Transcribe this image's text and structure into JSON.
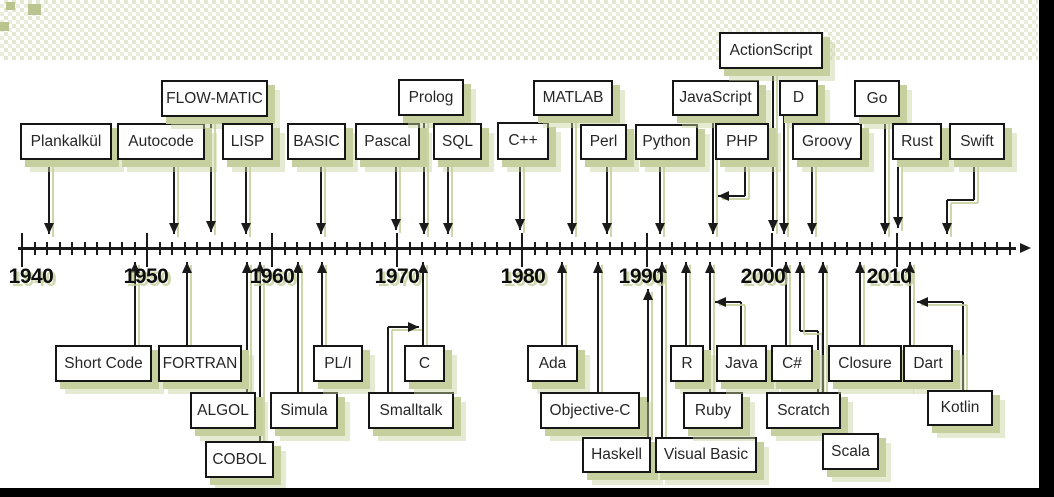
{
  "colors": {
    "shadow_green": "#c6d09f",
    "shadow_green_light": "#dde3c6",
    "line_black": "#1a1a1a",
    "box_border": "#161616",
    "box_bg": "#ffffff",
    "text": "#262626",
    "year_text": "#0d0d0d",
    "frame_black": "#000000"
  },
  "axis": {
    "y": 248,
    "x_start": 18,
    "x_end": 1016,
    "arrow_tip_x": 1031,
    "tick_start_x": 22,
    "tick_spacing": 12.5,
    "tick_count": 80,
    "decade_every": 10,
    "years": [
      {
        "label": "1940",
        "x": 31
      },
      {
        "label": "1950",
        "x": 146
      },
      {
        "label": "1960",
        "x": 272
      },
      {
        "label": "1970",
        "x": 397
      },
      {
        "label": "1980",
        "x": 523
      },
      {
        "label": "1990",
        "x": 641
      },
      {
        "label": "2000",
        "x": 763
      },
      {
        "label": "2010",
        "x": 889
      }
    ]
  },
  "languages": {
    "above": [
      {
        "label": "Plankalkül",
        "box": [
          20,
          123,
          92,
          37
        ],
        "line": [
          [
            49,
            160
          ],
          [
            49,
            234
          ]
        ],
        "arrow": "down"
      },
      {
        "label": "Autocode",
        "box": [
          117,
          123,
          88,
          37
        ],
        "line": [
          [
            174,
            160
          ],
          [
            174,
            234
          ]
        ],
        "arrow": "down"
      },
      {
        "label": "FLOW-MATIC",
        "box": [
          161,
          80,
          107,
          37
        ],
        "line": [
          [
            211,
            117
          ],
          [
            211,
            232
          ]
        ],
        "arrow": "down"
      },
      {
        "label": "LISP",
        "box": [
          222,
          123,
          51,
          37
        ],
        "line": [
          [
            246,
            160
          ],
          [
            246,
            234
          ]
        ],
        "arrow": "down"
      },
      {
        "label": "BASIC",
        "box": [
          287,
          123,
          59,
          37
        ],
        "line": [
          [
            321,
            160
          ],
          [
            321,
            234
          ]
        ],
        "arrow": "down"
      },
      {
        "label": "Pascal",
        "box": [
          355,
          123,
          65,
          37
        ],
        "line": [
          [
            396,
            160
          ],
          [
            396,
            230
          ]
        ],
        "arrow": "down"
      },
      {
        "label": "Prolog",
        "box": [
          398,
          79,
          66,
          37
        ],
        "line": [
          [
            424,
            116
          ],
          [
            424,
            234
          ]
        ],
        "arrow": "down"
      },
      {
        "label": "SQL",
        "box": [
          433,
          123,
          49,
          37
        ],
        "line": [
          [
            448,
            160
          ],
          [
            448,
            234
          ]
        ],
        "arrow": "down"
      },
      {
        "label": "C++",
        "box": [
          497,
          122,
          52,
          38
        ],
        "line": [
          [
            520,
            160
          ],
          [
            520,
            230
          ]
        ],
        "arrow": "down"
      },
      {
        "label": "MATLAB",
        "box": [
          533,
          80,
          80,
          36
        ],
        "line": [
          [
            572,
            116
          ],
          [
            572,
            234
          ]
        ],
        "arrow": "down"
      },
      {
        "label": "Perl",
        "box": [
          580,
          124,
          47,
          36
        ],
        "line": [
          [
            607,
            160
          ],
          [
            607,
            234
          ]
        ],
        "arrow": "down"
      },
      {
        "label": "Python",
        "box": [
          635,
          124,
          63,
          36
        ],
        "line": [
          [
            660,
            160
          ],
          [
            660,
            234
          ]
        ],
        "arrow": "down"
      },
      {
        "label": "JavaScript",
        "box": [
          672,
          80,
          87,
          36
        ],
        "line": [
          [
            713,
            116
          ],
          [
            713,
            234
          ]
        ],
        "arrow": "down"
      },
      {
        "label": "PHP",
        "box": [
          715,
          123,
          54,
          37
        ],
        "line": [
          [
            745,
            160
          ],
          [
            745,
            196
          ],
          [
            718,
            196
          ]
        ],
        "arrow": "left"
      },
      {
        "label": "ActionScript",
        "box": [
          719,
          32,
          104,
          37
        ],
        "line": [
          [
            773,
            69
          ],
          [
            773,
            231
          ]
        ],
        "arrow": "down"
      },
      {
        "label": "D",
        "box": [
          779,
          80,
          39,
          36
        ],
        "line": [
          [
            784,
            116
          ],
          [
            784,
            234
          ]
        ],
        "arrow": "down"
      },
      {
        "label": "Groovy",
        "box": [
          792,
          123,
          70,
          37
        ],
        "line": [
          [
            812,
            160
          ],
          [
            812,
            234
          ]
        ],
        "arrow": "down"
      },
      {
        "label": "Go",
        "box": [
          854,
          80,
          46,
          37
        ],
        "line": [
          [
            885,
            117
          ],
          [
            885,
            234
          ]
        ],
        "arrow": "down"
      },
      {
        "label": "Rust",
        "box": [
          892,
          123,
          50,
          37
        ],
        "line": [
          [
            898,
            160
          ],
          [
            898,
            228
          ]
        ],
        "arrow": "down"
      },
      {
        "label": "Swift",
        "box": [
          949,
          123,
          56,
          37
        ],
        "line": [
          [
            974,
            160
          ],
          [
            974,
            200
          ],
          [
            947,
            200
          ],
          [
            947,
            234
          ]
        ],
        "arrow": "down"
      }
    ],
    "below": [
      {
        "label": "Short Code",
        "box": [
          55,
          345,
          97,
          37
        ],
        "line": [
          [
            135,
            345
          ],
          [
            135,
            262
          ]
        ],
        "arrow": "up"
      },
      {
        "label": "FORTRAN",
        "box": [
          158,
          345,
          84,
          37
        ],
        "line": [
          [
            187,
            345
          ],
          [
            187,
            262
          ]
        ],
        "arrow": "up"
      },
      {
        "label": "ALGOL",
        "box": [
          190,
          392,
          66,
          37
        ],
        "line": [
          [
            247,
            392
          ],
          [
            247,
            262
          ]
        ],
        "arrow": "up"
      },
      {
        "label": "COBOL",
        "box": [
          205,
          441,
          69,
          37
        ],
        "line": [
          [
            260,
            441
          ],
          [
            260,
            262
          ]
        ],
        "arrow": "up"
      },
      {
        "label": "Simula",
        "box": [
          270,
          392,
          68,
          37
        ],
        "line": [
          [
            298,
            392
          ],
          [
            298,
            262
          ]
        ],
        "arrow": "up"
      },
      {
        "label": "PL/I",
        "box": [
          313,
          345,
          50,
          37
        ],
        "line": [
          [
            322,
            345
          ],
          [
            322,
            262
          ]
        ],
        "arrow": "up"
      },
      {
        "label": "Smalltalk",
        "box": [
          368,
          392,
          86,
          37
        ],
        "line": [
          [
            388,
            392
          ],
          [
            388,
            327
          ],
          [
            419,
            327
          ]
        ],
        "arrow": "right"
      },
      {
        "label": "C",
        "box": [
          404,
          345,
          41,
          37
        ],
        "line": [
          [
            423,
            345
          ],
          [
            423,
            262
          ]
        ],
        "arrow": "up"
      },
      {
        "label": "Ada",
        "box": [
          527,
          345,
          51,
          37
        ],
        "line": [
          [
            562,
            345
          ],
          [
            562,
            262
          ]
        ],
        "arrow": "up"
      },
      {
        "label": "Objective-C",
        "box": [
          540,
          392,
          100,
          37
        ],
        "line": [
          [
            598,
            392
          ],
          [
            598,
            262
          ]
        ],
        "arrow": "up"
      },
      {
        "label": "Haskell",
        "box": [
          582,
          437,
          69,
          36
        ],
        "line": [
          [
            648,
            437
          ],
          [
            648,
            289
          ]
        ],
        "arrow": "up"
      },
      {
        "label": "Visual Basic",
        "box": [
          655,
          437,
          102,
          36
        ],
        "line": [
          [
            662,
            437
          ],
          [
            662,
            262
          ]
        ],
        "arrow": "up"
      },
      {
        "label": "R",
        "box": [
          670,
          345,
          34,
          37
        ],
        "line": [
          [
            686,
            345
          ],
          [
            686,
            262
          ]
        ],
        "arrow": "up"
      },
      {
        "label": "Ruby",
        "box": [
          683,
          392,
          60,
          37
        ],
        "line": [
          [
            710,
            392
          ],
          [
            710,
            262
          ]
        ],
        "arrow": "up"
      },
      {
        "label": "Java",
        "box": [
          716,
          345,
          51,
          37
        ],
        "line": [
          [
            741,
            345
          ],
          [
            741,
            302
          ],
          [
            715,
            302
          ]
        ],
        "arrow": "left"
      },
      {
        "label": "C#",
        "box": [
          771,
          345,
          42,
          37
        ],
        "line": [
          [
            786,
            345
          ],
          [
            786,
            262
          ]
        ],
        "arrow": "up"
      },
      {
        "label": "Scratch",
        "box": [
          766,
          392,
          75,
          37
        ],
        "line": [
          [
            818,
            392
          ],
          [
            818,
            331
          ],
          [
            800,
            331
          ],
          [
            800,
            262
          ]
        ],
        "arrow": "up"
      },
      {
        "label": "Scala",
        "box": [
          822,
          433,
          57,
          37
        ],
        "line": [
          [
            823,
            433
          ],
          [
            823,
            262
          ]
        ],
        "arrow": "up"
      },
      {
        "label": "Closure",
        "box": [
          828,
          345,
          74,
          37
        ],
        "line": [
          [
            860,
            345
          ],
          [
            860,
            262
          ]
        ],
        "arrow": "up"
      },
      {
        "label": "Dart",
        "box": [
          903,
          345,
          50,
          37
        ],
        "line": [
          [
            910,
            345
          ],
          [
            910,
            262
          ]
        ],
        "arrow": "up"
      },
      {
        "label": "Kotlin",
        "box": [
          927,
          390,
          66,
          36
        ],
        "line": [
          [
            963,
            390
          ],
          [
            963,
            302
          ],
          [
            917,
            302
          ]
        ],
        "arrow": "left"
      }
    ]
  }
}
